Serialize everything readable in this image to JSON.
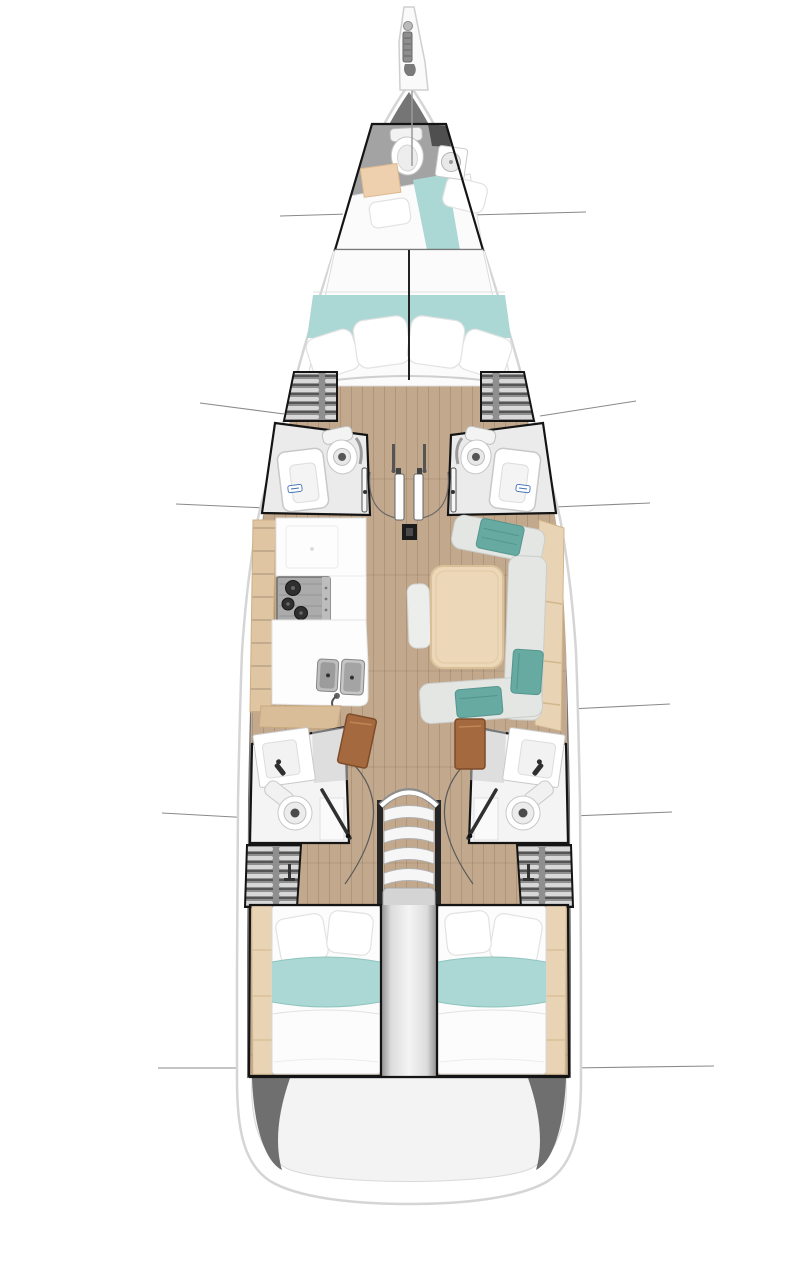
{
  "diagram": {
    "type": "yacht-interior-deck-plan",
    "description": "Top-down interior layout plan of a sailing yacht with forepeak crew cabin, owner V-berth cabin, two forward heads, galley, salon, two aft heads, companionway stairs and two aft double cabins",
    "areas": [
      {
        "id": "bowsprit",
        "label": "Bowsprit with anchor roller"
      },
      {
        "id": "forepeak",
        "label": "Forepeak crew cabin with toilet, sink and berth"
      },
      {
        "id": "owner-cabin",
        "label": "Forward owner cabin with V-berth double bed"
      },
      {
        "id": "wardrobe-port",
        "label": "Port louvered wardrobe"
      },
      {
        "id": "wardrobe-starboard",
        "label": "Starboard louvered wardrobe"
      },
      {
        "id": "head-fwd-port",
        "label": "Port forward head with toilet and shower tray"
      },
      {
        "id": "head-fwd-starboard",
        "label": "Starboard forward head with toilet and shower tray"
      },
      {
        "id": "mast-foot",
        "label": "Mast foot post"
      },
      {
        "id": "galley",
        "label": "Port galley with stove and double sink"
      },
      {
        "id": "salon",
        "label": "Starboard salon with table, settee and sideboard"
      },
      {
        "id": "head-aft-port",
        "label": "Port aft head with sink and toilet"
      },
      {
        "id": "head-aft-starboard",
        "label": "Starboard aft head with sink and toilet"
      },
      {
        "id": "companionway",
        "label": "Companionway stairs with landing"
      },
      {
        "id": "aft-cabin-port",
        "label": "Port aft double cabin"
      },
      {
        "id": "aft-cabin-starboard",
        "label": "Starboard aft double cabin"
      },
      {
        "id": "engine-box",
        "label": "Center engine compartment between aft cabins"
      },
      {
        "id": "transom",
        "label": "Stern transom"
      },
      {
        "id": "hull",
        "label": "Hull outline"
      }
    ],
    "callout_lines": {
      "left_y": [
        215,
        408,
        506,
        815,
        1068
      ],
      "right_y": [
        213,
        408,
        505,
        706,
        814,
        1067
      ]
    }
  },
  "theme": {
    "c-band": "#757575",
    "c-hullline": "#d5d5d5",
    "c-floor": "#c2a88d",
    "c-bedteal": "#abd8d4",
    "c-cushteal": "#66aaa2",
    "c-tan": "#e8d4b4",
    "c-shelf": "#dfc5a2",
    "c-table": "#ecd8b8",
    "c-brown": "#a5693f",
    "c-louver": "#8f8f8f",
    "c-border": "#141414",
    "c-callout": "#8a8a8a",
    "c-transom": "#f3f3f3",
    "c-stove": "#ababab"
  }
}
